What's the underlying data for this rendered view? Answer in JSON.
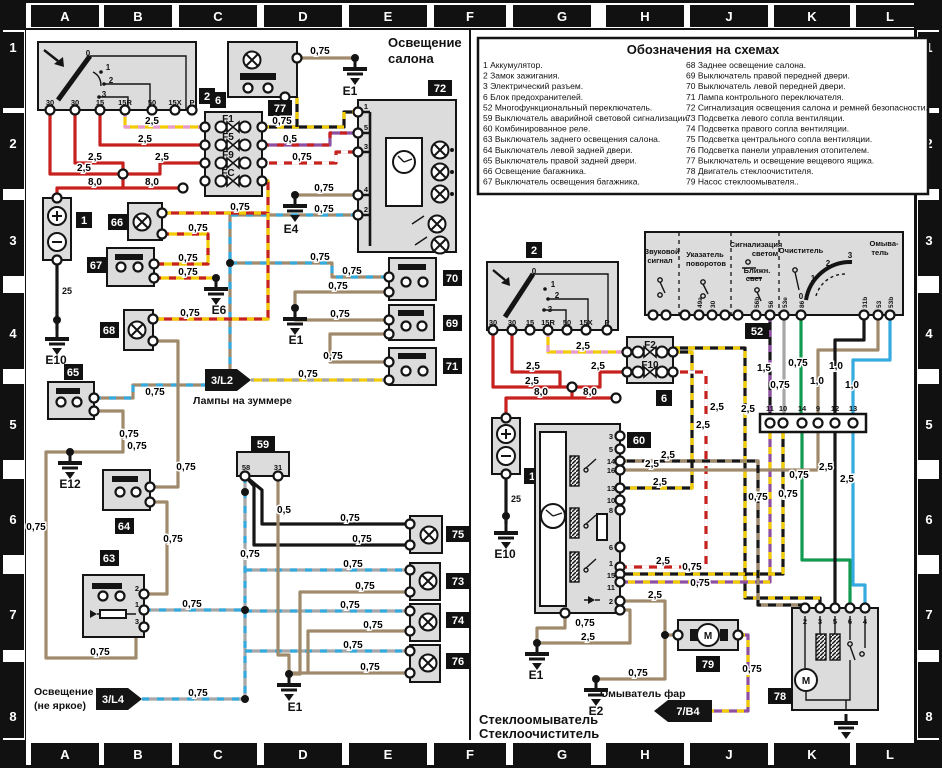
{
  "grid": {
    "cols": [
      "A",
      "B",
      "C",
      "D",
      "E",
      "F",
      "G",
      "H",
      "J",
      "K",
      "L"
    ],
    "rows": [
      "1",
      "2",
      "3",
      "4",
      "5",
      "6",
      "7",
      "8"
    ]
  },
  "titles": {
    "left1": "Освещение",
    "left2": "салона",
    "bottom1": "Стеклоомыватель",
    "bottom2": "Стеклоочиститель"
  },
  "legend": {
    "title": "Обозначения на схемах",
    "left": [
      "1 Аккумулятор.",
      "2 Замок зажигания.",
      "3 Электрический разъем.",
      "6 Блок предохранителей.",
      "52 Многофункциональный переключатель.",
      "59 Выключатель аварийной световой сигнализации.",
      "60 Комбинированное реле.",
      "63 Выключатель заднего освещения салона.",
      "64 Выключатель левой задней двери.",
      "65 Выключатель правой задней двери.",
      "66 Освещение багажника.",
      "67 Выключатель освещения багажника."
    ],
    "right": [
      "68 Заднее освещение салона.",
      "69 Выключатель правой передней двери.",
      "70 Выключатель левой передней двери.",
      "71 Лампа контрольного переключателя.",
      "72 Сигнализация освещения салона и ремней безопасности.",
      "73 Подсветка левого сопла вентиляции.",
      "74 Подсветка правого сопла вентиляции.",
      "75 Подсветка центрального сопла вентиляции.",
      "76 Подсветка панели управления отопителем.",
      "77 Выключатель и освещение вещевого ящика.",
      "78 Двигатель стеклоочистителя.",
      "79 Насос стеклоомывателя.."
    ]
  },
  "g": {
    "w05": "0,5",
    "w075": "0,75",
    "w10": "1,0",
    "w15": "1,5",
    "w25": "2,5",
    "w80": "8,0"
  },
  "badges": {
    "n1": "1",
    "n2": "2",
    "n6": "6",
    "n52": "52",
    "n59": "59",
    "n60": "60",
    "n63": "63",
    "n64": "64",
    "n65": "65",
    "n66": "66",
    "n67": "67",
    "n68": "68",
    "n69": "69",
    "n70": "70",
    "n71": "71",
    "n72": "72",
    "n73": "73",
    "n74": "74",
    "n75": "75",
    "n76": "76",
    "n77": "77",
    "n78": "78",
    "n79": "79"
  },
  "grounds": {
    "e1": "E1",
    "e2": "E2",
    "e4": "E4",
    "e6": "E6",
    "e10": "E10",
    "e12": "E12"
  },
  "arrows": {
    "l2": "3/L2",
    "l4": "3/L4",
    "b4": "7/B4",
    "l2cap": "Лампы на зуммере",
    "l4cap1": "Освещение",
    "l4cap2": "(не яркое)",
    "b4cap": "Омыватель фар"
  },
  "ignition": {
    "terminals": [
      "30",
      "30",
      "15",
      "15R",
      "50",
      "15X",
      "P"
    ],
    "positions": [
      "0",
      "1",
      "2",
      "3"
    ]
  },
  "fuses": {
    "left": [
      "F1",
      "F5",
      "F9",
      "FC"
    ],
    "right": [
      "F2",
      "F10"
    ]
  },
  "battery": {
    "wire": "25"
  },
  "motor": "M",
  "relay60": [
    "3",
    "5",
    "14",
    "16",
    "13",
    "10",
    "8",
    "6",
    "1",
    "15",
    "11",
    "2"
  ],
  "block59": [
    "58",
    "31"
  ],
  "block63": [
    "2",
    "1",
    "3"
  ],
  "block72": [
    "1",
    "5",
    "3",
    "4",
    "2"
  ],
  "block78": [
    "2",
    "3",
    "5",
    "6",
    "4"
  ],
  "connector": [
    "11",
    "10",
    "14",
    "9",
    "12",
    "13"
  ],
  "ms52": {
    "labels": {
      "horn1": "Звуковой",
      "horn2": "сигнал",
      "turn1": "Указатель",
      "turn2": "поворотов",
      "flash1": "Сигнализация",
      "flash2": "светом",
      "low1": "Ближн.",
      "low2": "свет",
      "wipe": "Очиститель",
      "wash1": "Омыва-",
      "wash2": "тель"
    },
    "terminals": [
      "49a",
      "30",
      "56b",
      "56",
      "53e",
      "86",
      "31b",
      "53",
      "53b"
    ]
  }
}
